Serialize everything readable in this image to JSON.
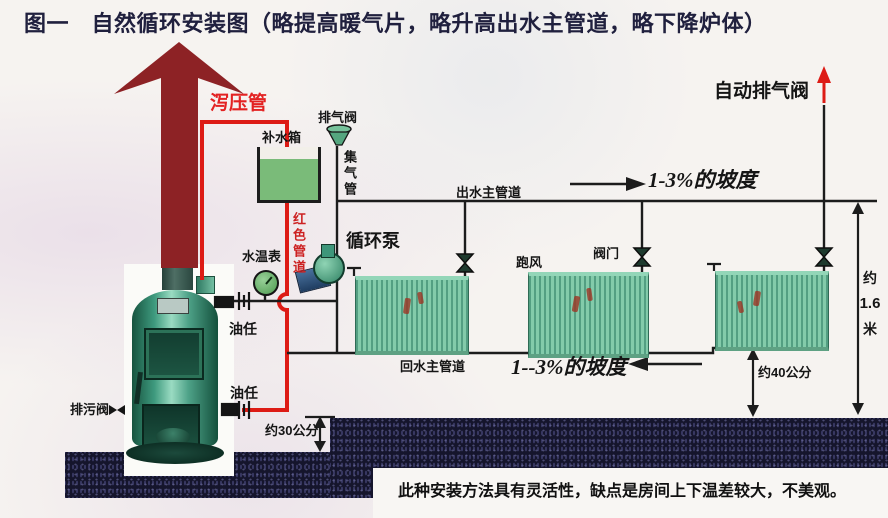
{
  "figure": {
    "title": "图一　自然循环安装图（略提高暖气片，略升高出水主管道，略下降炉体）",
    "caption": "此种安装方法具有灵活性，缺点是房间上下温差较大，不美观。"
  },
  "labels": {
    "relief_pipe": "泻压管",
    "exhaust_valve": "排气阀",
    "makeup_tank": "补水箱",
    "gas_collector_pipe": "集气管",
    "red_pipe": "红色管道",
    "water_temp_gauge": "水温表",
    "union_upper": "油任",
    "union_lower": "油任",
    "drain_valve": "排污阀",
    "circulation_pump": "循环泵",
    "supply_main": "出水主管道",
    "auto_air_vent": "自动排气阀",
    "radiator_air_vent": "跑风",
    "radiator_valve": "阀门",
    "return_main": "回水主管道"
  },
  "annotations": {
    "slope_top": "1-3%的坡度",
    "slope_bottom": "1--3%的坡度",
    "pit_depth": "约30公分",
    "return_height": "约40公分",
    "total_height": {
      "prefix": "约",
      "value": "1.6",
      "unit": "米"
    }
  },
  "colors": {
    "pipe_red": "#dd1b15",
    "arrow_maroon": "#8d2225",
    "line_black": "#1c1c1c",
    "radiator_green": "#7fc7a6",
    "tank_water_green": "#7abb79",
    "ground_dark": "#15152c",
    "label_red": "#e32222",
    "title_navy": "#20203e"
  }
}
